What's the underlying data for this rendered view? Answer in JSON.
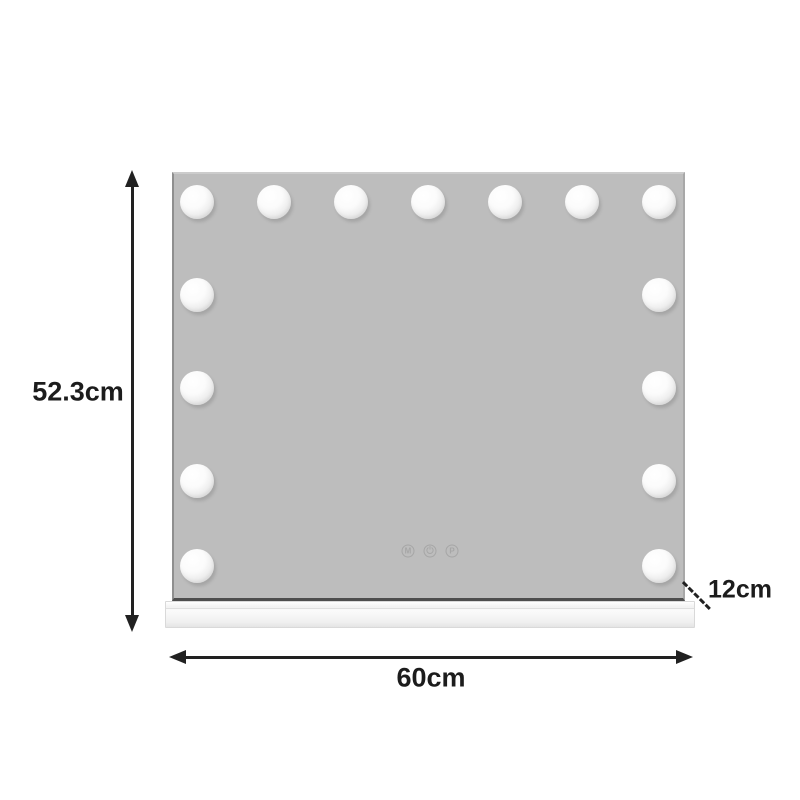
{
  "dimensions": {
    "height": "52.3cm",
    "width": "60cm",
    "depth": "12cm"
  },
  "mirror": {
    "bulb_count": 15,
    "touch_controls": {
      "memory": "M",
      "power_icon": "power-icon",
      "program": "P"
    }
  },
  "colors": {
    "mirror_face": "#bdbdbd",
    "bulb": "#f5f5f5",
    "base": "#f2f2f2",
    "dimension_lines": "#212121"
  }
}
